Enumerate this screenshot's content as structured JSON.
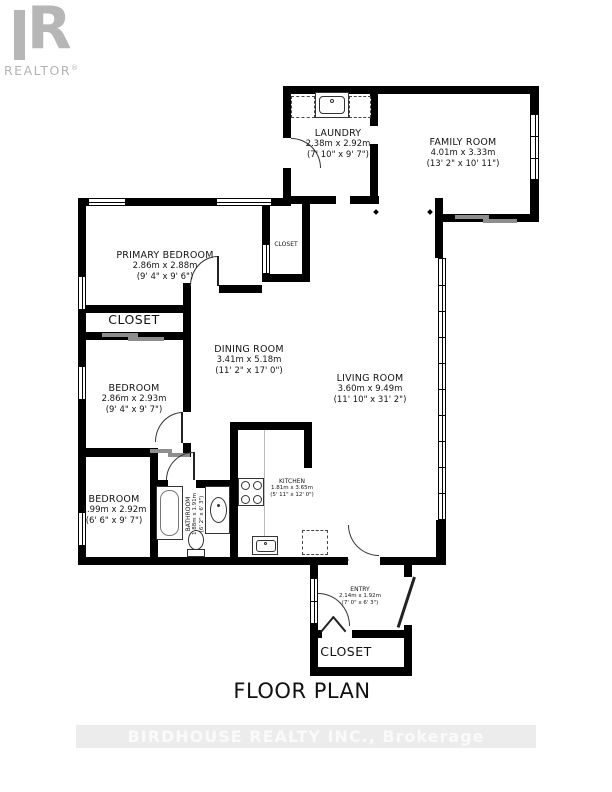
{
  "logo": {
    "letter": "R",
    "brand": "REALTOR",
    "registered_mark": "®"
  },
  "title": "FLOOR PLAN",
  "watermark": "BIRDHOUSE REALTY INC., Brokerage",
  "rooms": {
    "laundry": {
      "name": "LAUNDRY",
      "metric": "2.38m x 2.92m",
      "imperial": "(7' 10\" x 9' 7\")"
    },
    "family": {
      "name": "FAMILY ROOM",
      "metric": "4.01m x 3.33m",
      "imperial": "(13' 2\" x 10' 11\")"
    },
    "primary": {
      "name": "PRIMARY BEDROOM",
      "metric": "2.86m x 2.88m",
      "imperial": "(9' 4\" x 9' 6\")"
    },
    "closet_hall": {
      "name": "CLOSET"
    },
    "closet_primary": {
      "name": "CLOSET"
    },
    "dining": {
      "name": "DINING ROOM",
      "metric": "3.41m x 5.18m",
      "imperial": "(11' 2\" x 17' 0\")"
    },
    "living": {
      "name": "LIVING ROOM",
      "metric": "3.60m x 9.49m",
      "imperial": "(11' 10\" x 31' 2\")"
    },
    "bedroom2": {
      "name": "BEDROOM",
      "metric": "2.86m x 2.93m",
      "imperial": "(9' 4\" x 9' 7\")"
    },
    "bedroom3": {
      "name": "BEDROOM",
      "metric": "1.99m x 2.92m",
      "imperial": "(6' 6\" x 9' 7\")"
    },
    "bathroom": {
      "name": "BATHROOM",
      "metric": "1.88m x 1.91m",
      "imperial": "(6' 2\" x 6' 3\")"
    },
    "kitchen": {
      "name": "KITCHEN",
      "metric": "1.81m x 3.65m",
      "imperial": "(5' 11\" x 12' 0\")"
    },
    "entry": {
      "name": "ENTRY",
      "metric": "2.14m x 1.92m",
      "imperial": "(7' 0\" x 6' 3\")"
    },
    "closet_entry": {
      "name": "CLOSET"
    }
  },
  "colors": {
    "wall": "#000000",
    "logo_gray": "#b6b6b6",
    "watermark_text": "#fafafa",
    "watermark_band": "#ececec",
    "slider_gray": "#8e8e8e"
  }
}
